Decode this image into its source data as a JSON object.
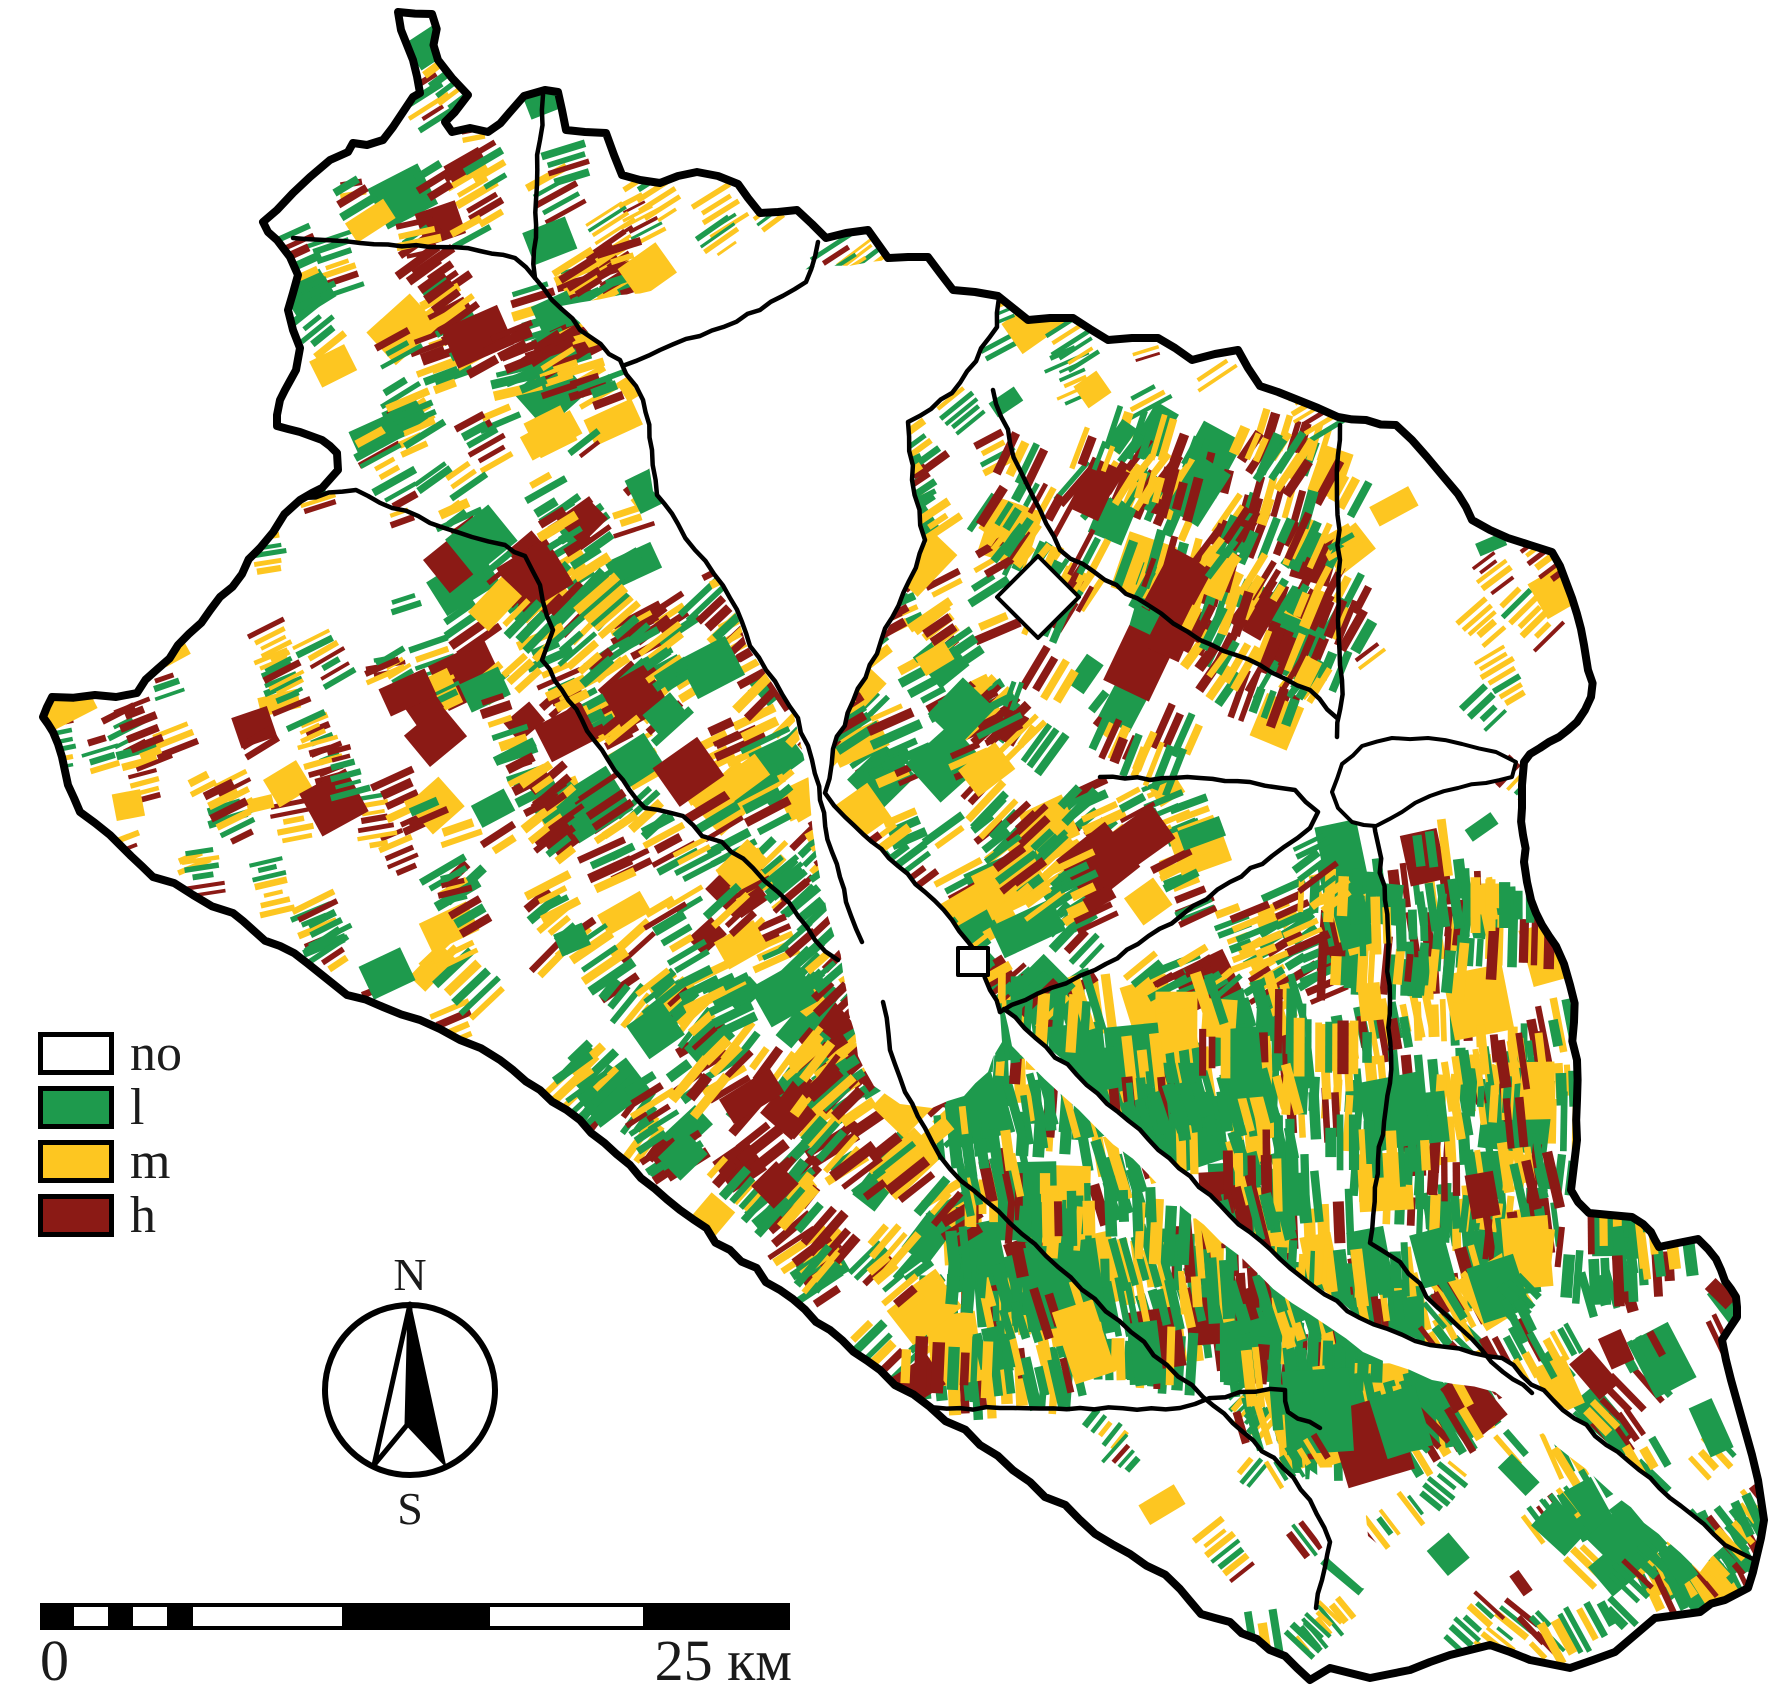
{
  "map": {
    "type": "land-classification-choropleth",
    "region_fill": "#FFFFFF",
    "boundary_color": "#000000",
    "legend_items": [
      {
        "label": "no",
        "color": "#FFFFFF"
      },
      {
        "label": "l",
        "color": "#1E9A4D"
      },
      {
        "label": "m",
        "color": "#FDC621"
      },
      {
        "label": "h",
        "color": "#8B1A15"
      }
    ]
  },
  "compass": {
    "north_label": "N",
    "south_label": "S"
  },
  "scalebar": {
    "start_label": "0",
    "end_label": "25 км"
  }
}
